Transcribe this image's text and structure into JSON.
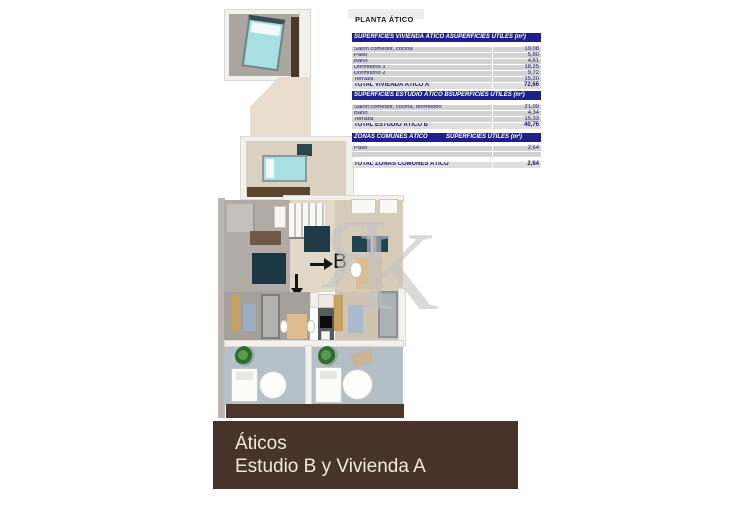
{
  "title": "PLANTA ÁTICO",
  "tables": [
    {
      "header_left": "SUPERFICIES VIVIENDA ÁTICO A",
      "header_right": "SUPERFICIES ÚTILES  (m²)",
      "rows": [
        {
          "label": "Salón comedor, cocina",
          "value": "19,08"
        },
        {
          "label": "Paso",
          "value": "5,80"
        },
        {
          "label": "Baño",
          "value": "4,61"
        },
        {
          "label": "Dormitorio 1",
          "value": "18,25"
        },
        {
          "label": "Dormitorio 2",
          "value": "9,72"
        },
        {
          "label": "Terraza",
          "value": "15,20"
        }
      ],
      "total_label": "TOTAL VIVIENDA ÁTICO A",
      "total_value": "72,66"
    },
    {
      "header_left": "SUPERFICIES ESTUDIO ÁTICO B",
      "header_right": "SUPERFICIES ÚTILES  (m²)",
      "rows": [
        {
          "label": "Salón comedor, cocina, dormitorio",
          "value": "21,09"
        },
        {
          "label": "Baño",
          "value": "4,34"
        },
        {
          "label": "Terraza",
          "value": "15,33"
        }
      ],
      "total_label": "TOTAL ESTUDIO ÁTICO B",
      "total_value": "40,76"
    },
    {
      "header_left": "ZONAS COMUNES ÁTICO",
      "header_right": "SUPERFICIES ÚTILES  (m²)",
      "rows": [
        {
          "label": "Paso",
          "value": "2,64"
        }
      ],
      "total_label": "TOTAL ZONAS COMUNES ÁTICO",
      "total_value": "2,64"
    }
  ],
  "plan": {
    "unit_a_label": "A",
    "unit_b_label": "B"
  },
  "watermark": {
    "letter_r": "Я",
    "letter_k": "K"
  },
  "banner": {
    "line1": "Áticos",
    "line2": "Estudio B y Vivienda A"
  },
  "colors": {
    "table_header_navy": "#20208a",
    "table_row_gray": "#d2d2d2",
    "banner_brown": "#48332b",
    "banner_text": "#f2e9df",
    "bed_cyan": "#a8dfe3",
    "terrace_blue": "#b5c0c8",
    "furniture_navy": "#1e3a47",
    "wood_brown": "#4a382a"
  }
}
